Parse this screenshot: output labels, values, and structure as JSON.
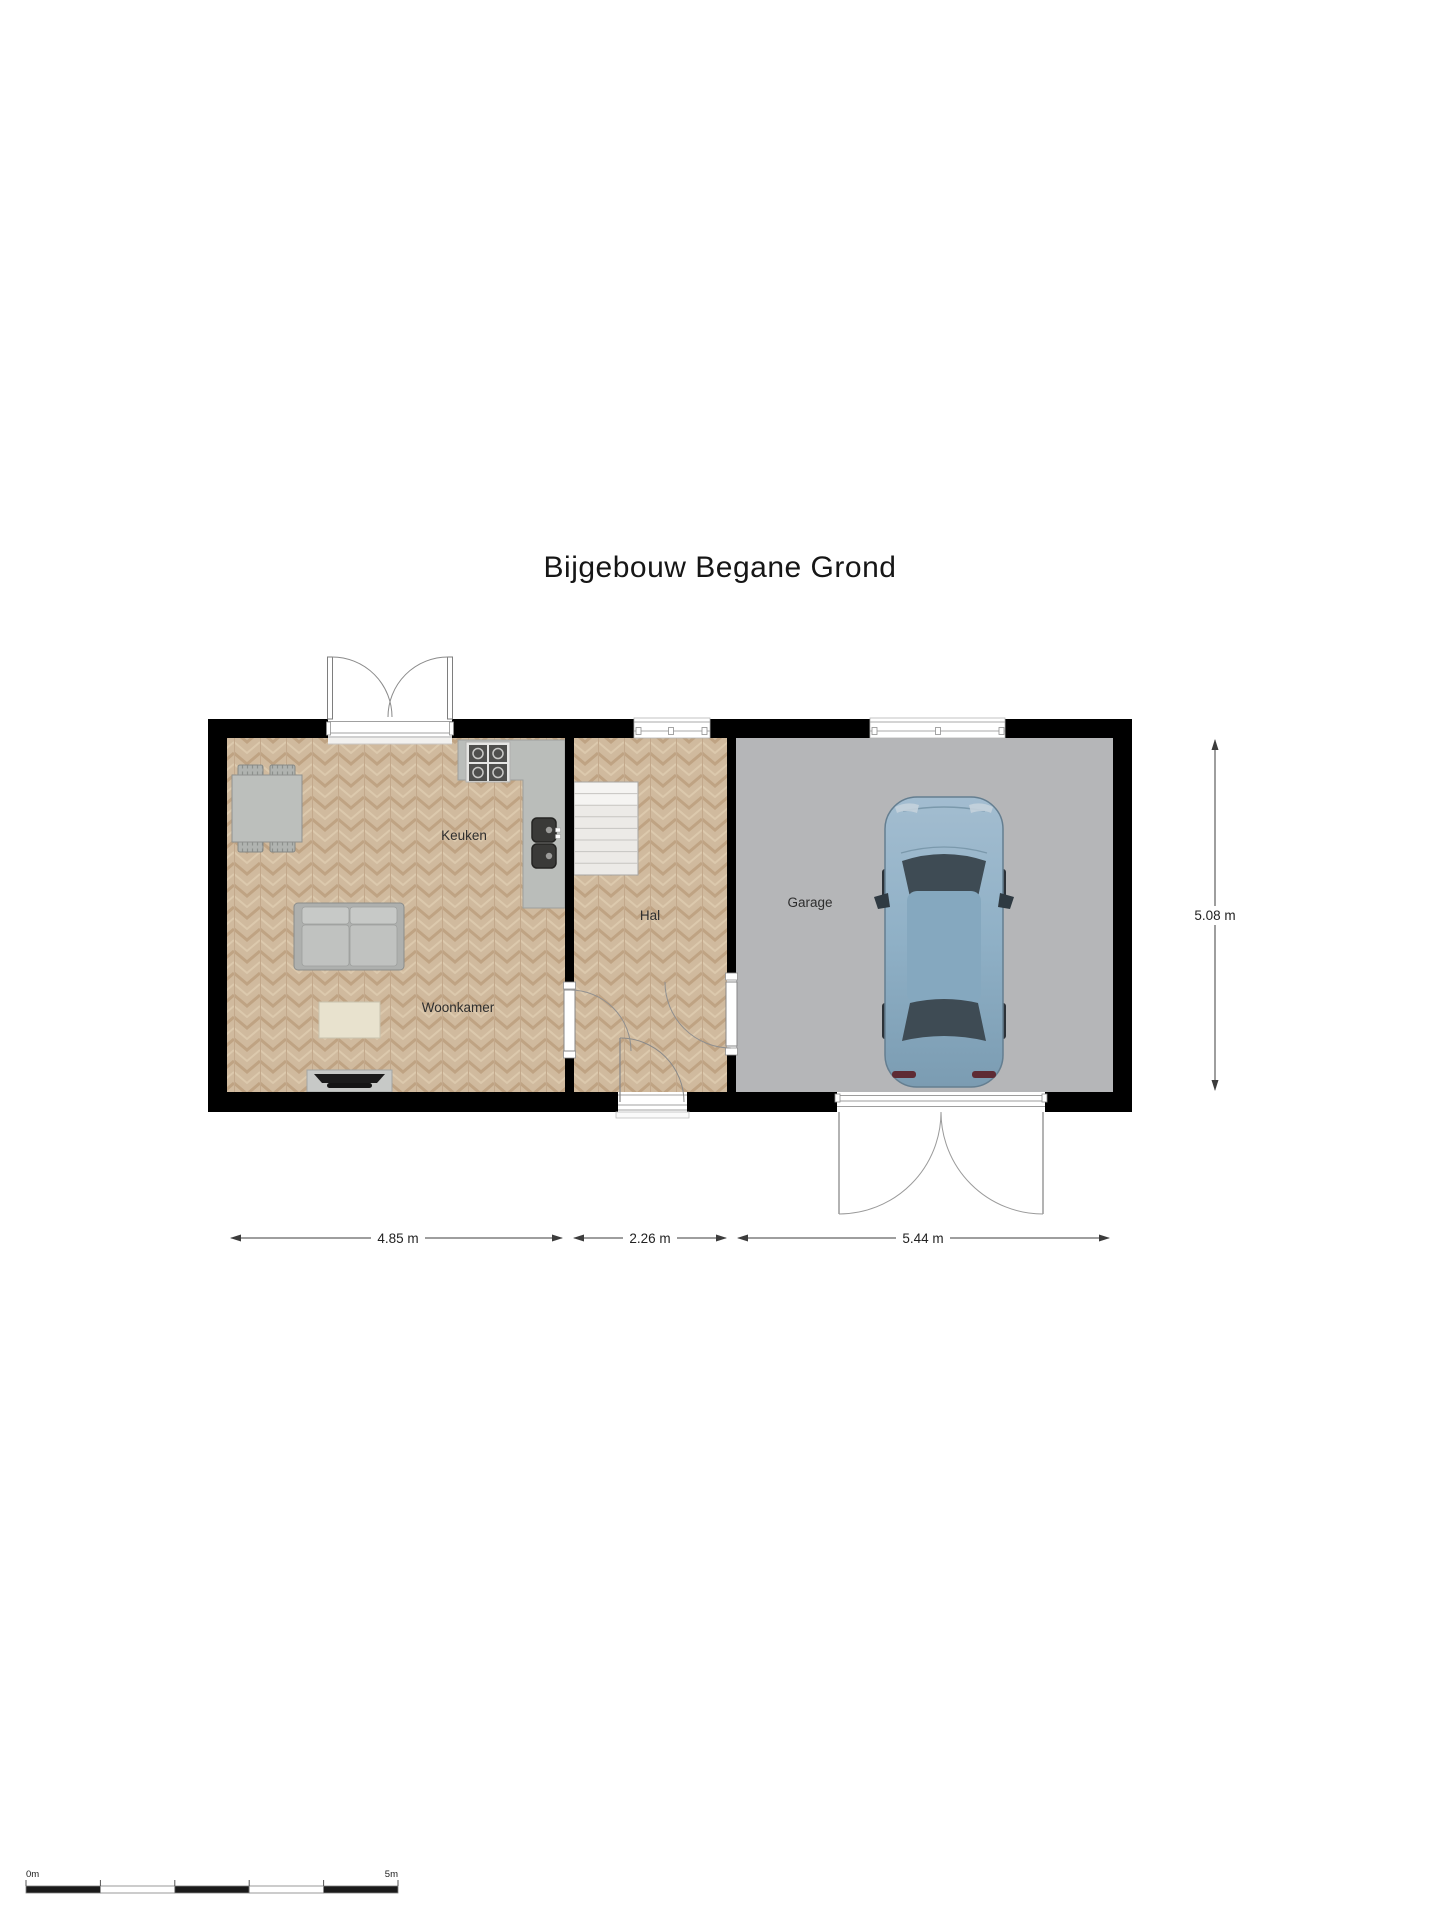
{
  "title": "Bijgebouw Begane Grond",
  "rooms": {
    "keuken": "Keuken",
    "woonkamer": "Woonkamer",
    "hal": "Hal",
    "garage": "Garage"
  },
  "dimensions": {
    "woonkamer_width": "4.85 m",
    "hal_width": "2.26 m",
    "garage_width": "5.44 m",
    "total_depth": "5.08 m"
  },
  "scale_bar": {
    "start_label": "0m",
    "end_label": "5m"
  },
  "colors": {
    "wall": "#000000",
    "wood_floor": "#d0ba9e",
    "garage_floor": "#b5b6b8",
    "counter": "#babdba",
    "stairs": "#eceae7",
    "car_body": "#8fb0c6",
    "dimension_line": "#3c3c3c"
  }
}
